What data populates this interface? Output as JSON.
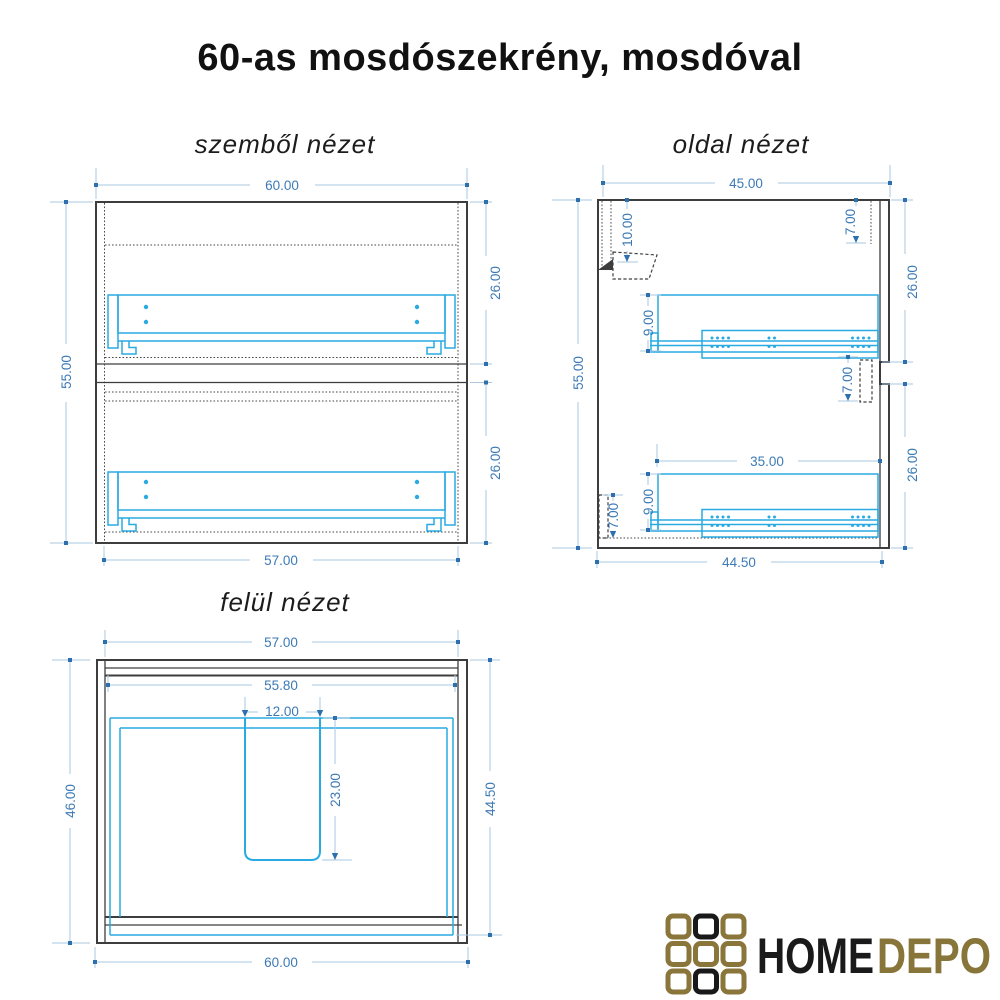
{
  "title": "60-as mosdószekrény, mosdóval",
  "views": {
    "front": {
      "label": "szemből nézet",
      "dims": {
        "top_width": "60.00",
        "left_height": "55.00",
        "right_upper": "26.00",
        "right_lower": "26.00",
        "bottom_width": "57.00"
      }
    },
    "side": {
      "label": "oldal nézet",
      "dims": {
        "top_depth": "45.00",
        "left_height": "55.00",
        "back_inset": "10.00",
        "front_top": "7.00",
        "right_upper": "26.00",
        "rail_height_upper": "9.00",
        "front_mid": "7.00",
        "rail_length": "35.00",
        "right_lower": "26.00",
        "rail_height_lower": "9.00",
        "plinth_height": "7.00",
        "bottom_depth": "44.50"
      }
    },
    "top": {
      "label": "felül nézet",
      "dims": {
        "top_width": "57.00",
        "inner_width": "55.80",
        "drain_width": "12.00",
        "drain_depth": "23.00",
        "left_depth": "46.00",
        "right_depth": "44.50",
        "bottom_width": "60.00"
      }
    }
  },
  "logo": {
    "brand_primary": "HOME",
    "brand_secondary": "DEPO"
  },
  "colors": {
    "drawing_black": "#3d3d3d",
    "hardware_cyan": "#29abe2",
    "dim_line": "#a9c7e2",
    "dim_text": "#3d7ab5",
    "logo_gold": "#8a763b",
    "logo_black": "#1a1a1a"
  }
}
